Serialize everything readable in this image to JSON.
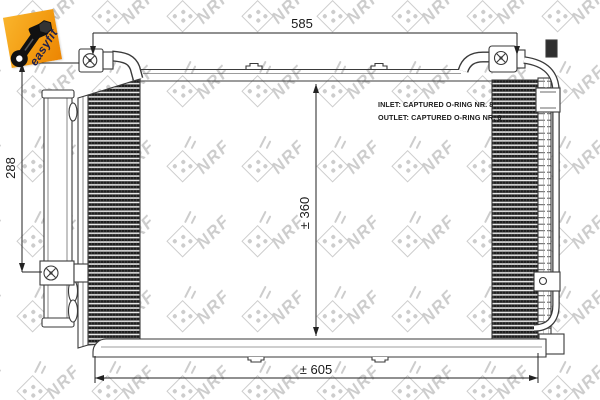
{
  "badge": {
    "label": "easyfit",
    "icon": "wrench-bolt-icon"
  },
  "watermark": {
    "text": "NRF"
  },
  "colors": {
    "line": "#3a3a3a",
    "text": "#1a1a1a",
    "watermark_gray": "#cdcdcd",
    "badge_orange": "#f39c12",
    "fins_dark": "#1e1e1e"
  },
  "annotations": {
    "dimensions": [
      {
        "id": "width-top",
        "label": "585",
        "orientation": "horizontal"
      },
      {
        "id": "height-left",
        "label": "288",
        "orientation": "vertical"
      },
      {
        "id": "height-core",
        "label": "± 360",
        "orientation": "vertical"
      },
      {
        "id": "width-bottom",
        "label": "± 605",
        "orientation": "horizontal"
      }
    ],
    "notes": [
      {
        "id": "inlet",
        "text": "INLET: CAPTURED O-RING NR. 8"
      },
      {
        "id": "outlet",
        "text": "OUTLET: CAPTURED O-RING NR. 6"
      }
    ]
  }
}
